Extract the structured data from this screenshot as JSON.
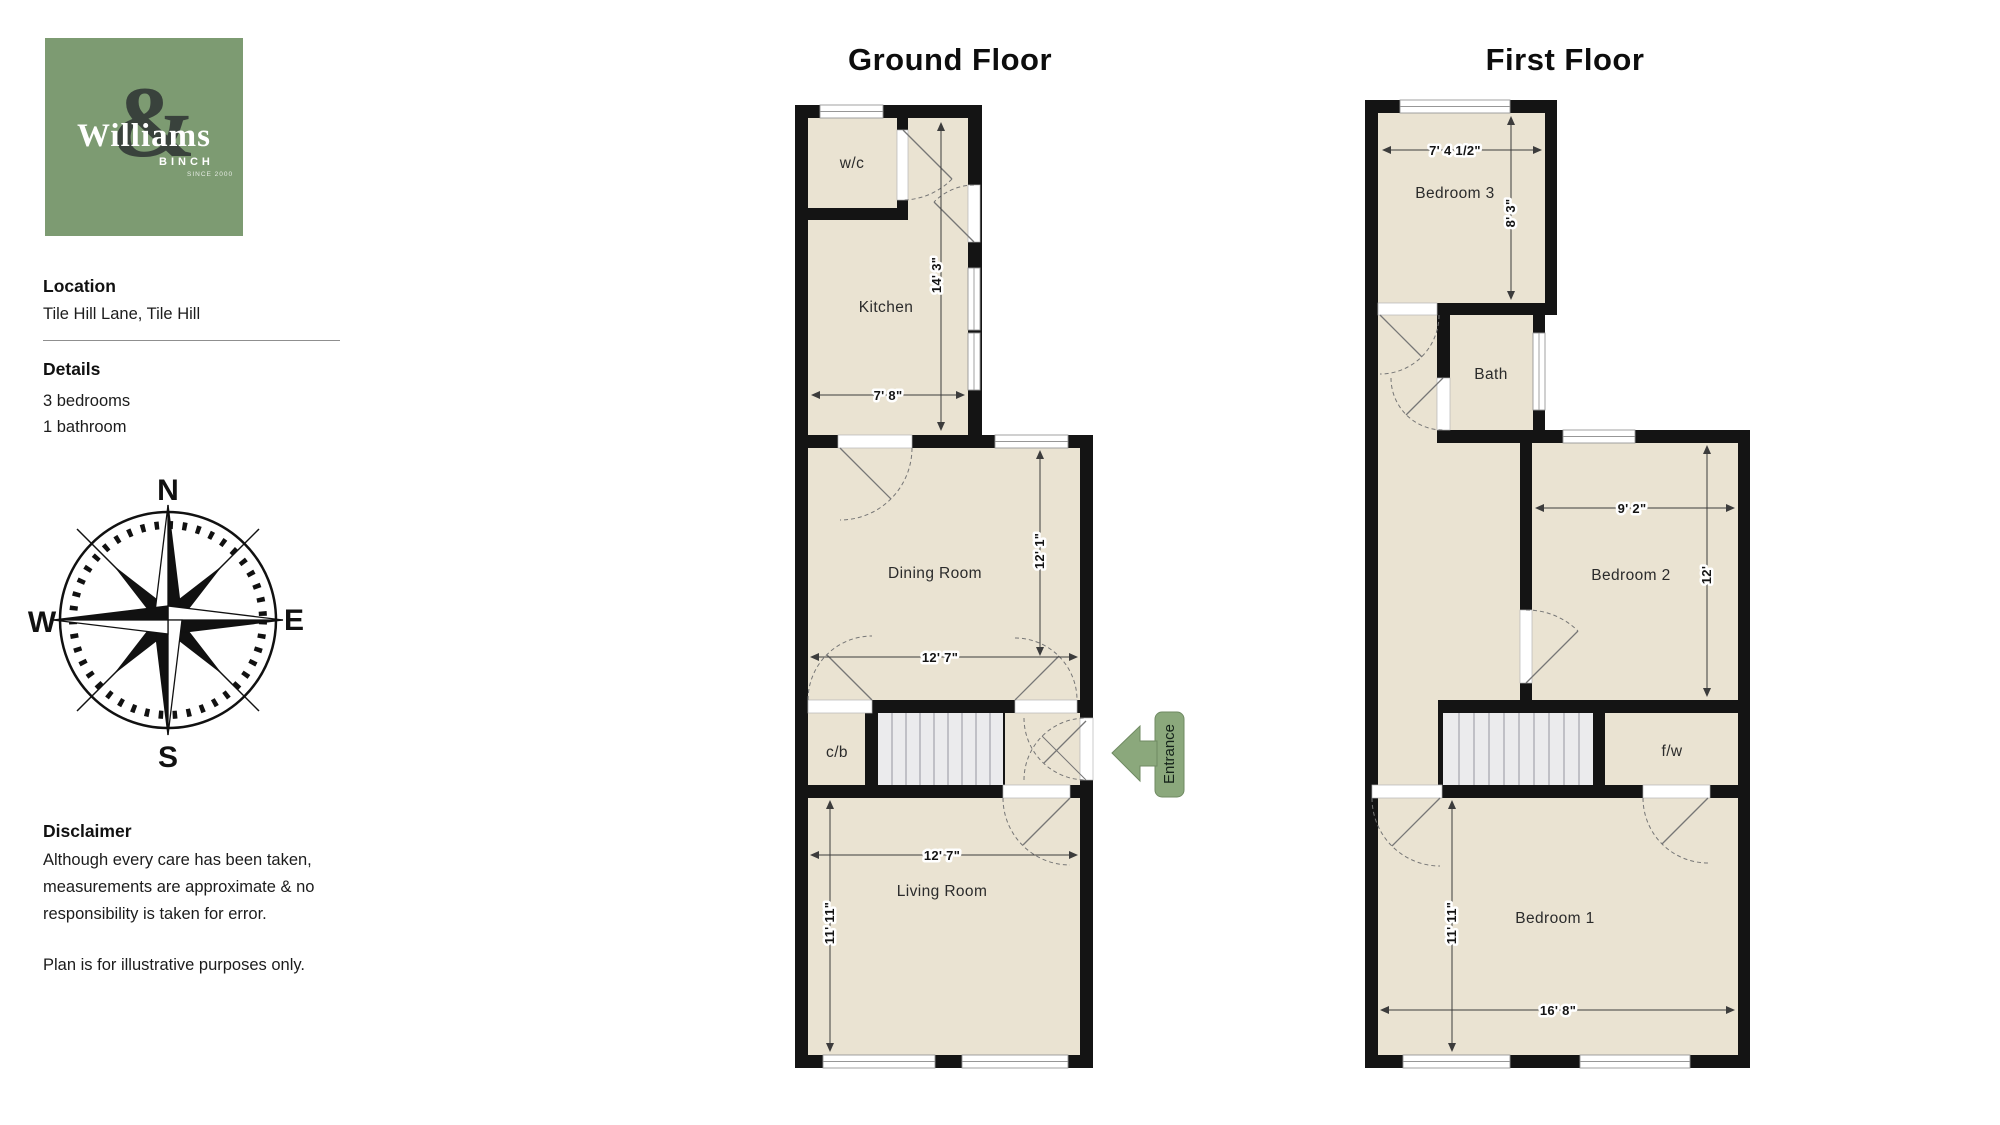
{
  "branding": {
    "name": "Williams",
    "amp": "&",
    "sub": "BINCH",
    "since": "SINCE 2000",
    "logo_bg_color": "#7d9b72"
  },
  "sidebar": {
    "location_label": "Location",
    "location_value": "Tile Hill Lane, Tile Hill",
    "details_label": "Details",
    "details": [
      "3 bedrooms",
      "1 bathroom"
    ],
    "disclaimer_label": "Disclaimer",
    "disclaimer_p1": "Although every care has been taken, measurements are approximate & no responsibility is taken for error.",
    "disclaimer_p2": "Plan is for illustrative purposes only."
  },
  "compass": {
    "n": "N",
    "e": "E",
    "s": "S",
    "w": "W",
    "north_color": "#6f8e63"
  },
  "floors": {
    "ground": {
      "title": "Ground Floor",
      "rooms": {
        "wc": "w/c",
        "kitchen": "Kitchen",
        "dining": "Dining Room",
        "cb": "c/b",
        "living": "Living Room"
      },
      "dims": {
        "kitchen_h": "14' 3\"",
        "kitchen_w": "7' 8\"",
        "dining_h": "12' 1\"",
        "dining_w": "12' 7\"",
        "living_w": "12' 7\"",
        "living_h": "11' 11\""
      },
      "entrance_label": "Entrance"
    },
    "first": {
      "title": "First Floor",
      "rooms": {
        "bedroom3": "Bedroom 3",
        "bath": "Bath",
        "bedroom2": "Bedroom 2",
        "fw": "f/w",
        "bedroom1": "Bedroom 1"
      },
      "dims": {
        "bed3_w": "7' 4 1/2\"",
        "bed3_h": "8' 3\"",
        "bed2_w": "9' 2\"",
        "bed2_h": "12'",
        "bed1_h": "11' 11\"",
        "bed1_w": "16' 8\""
      }
    }
  },
  "colors": {
    "wall": "#141414",
    "room_fill": "#eae3d2",
    "stairs_fill": "#ebebed",
    "entrance_arrow": "#8ba87c"
  }
}
